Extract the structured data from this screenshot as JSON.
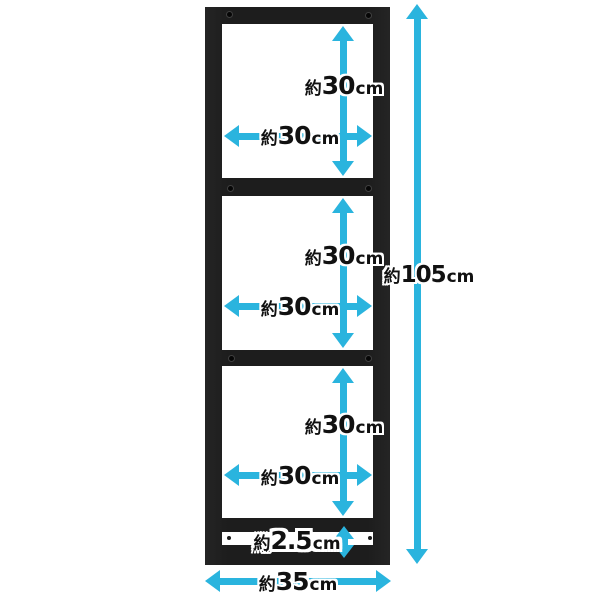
{
  "diagram": {
    "description": "Dimension diagram of a black 3-tier steel rack frame",
    "measurements": {
      "section1_height": {
        "prefix": "約",
        "value": "30",
        "unit": "cm"
      },
      "section1_width": {
        "prefix": "約",
        "value": "30",
        "unit": "cm"
      },
      "section2_height": {
        "prefix": "約",
        "value": "30",
        "unit": "cm"
      },
      "section2_width": {
        "prefix": "約",
        "value": "30",
        "unit": "cm"
      },
      "section3_height": {
        "prefix": "約",
        "value": "30",
        "unit": "cm"
      },
      "section3_width": {
        "prefix": "約",
        "value": "30",
        "unit": "cm"
      },
      "total_height": {
        "prefix": "約",
        "value": "105",
        "unit": "cm"
      },
      "bottom_rail_gap": {
        "prefix": "約",
        "value": "2.5",
        "unit": "cm"
      },
      "total_width": {
        "prefix": "約",
        "value": "35",
        "unit": "cm"
      }
    },
    "colors": {
      "frame": "#1d1d1d",
      "arrow": "#2ab4de",
      "label_text": "#111111",
      "label_outline": "#ffffff",
      "background": "#ffffff"
    }
  }
}
